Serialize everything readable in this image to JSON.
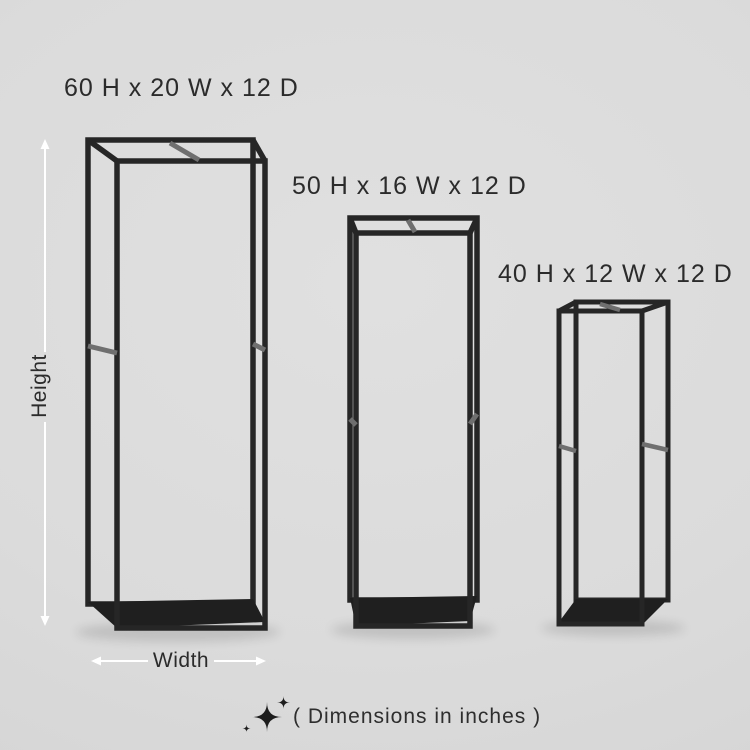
{
  "colors": {
    "background": "#dbdbdb",
    "frame": "#262626",
    "shelf": "#1f1f1f",
    "rail": "#6f6f6f",
    "text": "#2b2b2b",
    "caption_text": "#2e2e2e",
    "arrow": "#ffffff",
    "icon": "#1d1d1d"
  },
  "products": [
    {
      "label": "60 H x 20 W x 12 D",
      "height_in": 60,
      "width_in": 20,
      "depth_in": 12
    },
    {
      "label": "50 H x 16 W x 12 D",
      "height_in": 50,
      "width_in": 16,
      "depth_in": 12
    },
    {
      "label": "40 H x 12 W x 12 D",
      "height_in": 40,
      "width_in": 12,
      "depth_in": 12
    }
  ],
  "dimension_arrows": {
    "height_label": "Height",
    "width_label": "Width"
  },
  "caption": {
    "icon": "sparkles-icon",
    "text": "( Dimensions in inches )"
  }
}
